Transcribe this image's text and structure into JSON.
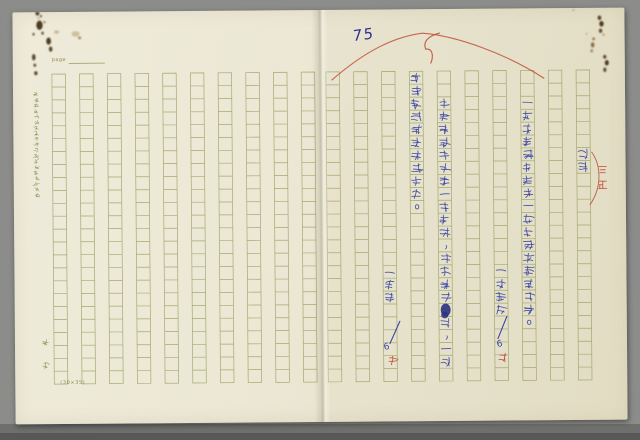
{
  "page_number": "75",
  "stationery": {
    "page_label": "page",
    "grid_label": "(30×35)",
    "brand_vertical": "文觀",
    "margin_note": "本稿紙格式注意事項請用墨筆書寫力求清晰",
    "paper_color": "#ece8d5",
    "grid_color": "#9aa163",
    "columns_per_page": 10,
    "rows_per_column": 24
  },
  "handwriting": {
    "ink_blue": "#3a44a0",
    "ink_red": "#bf4f3a",
    "page_number_color": "#2b3193",
    "columns": [
      {
        "column": 4,
        "start_row": 0,
        "chars": "要比接受批评太易得多。"
      },
      {
        "column": 5,
        "start_row": 2,
        "chars": "迫害是社會公害一性法律，因為到批█评，一直"
      },
      {
        "column": 8,
        "start_row": 2,
        "chars": "—迫害是这種手段一種纸裡之間接解述。"
      },
      {
        "column": 10,
        "start_row": 6,
        "chars": "迫害"
      },
      {
        "column": 3,
        "start_row": 15,
        "chars": "—緯斯"
      },
      {
        "column": 7,
        "start_row": 15,
        "chars": "—好朋思"
      }
    ],
    "proof_marks": [
      {
        "column": 3,
        "slash": "/",
        "number": "6",
        "red_char": "在"
      },
      {
        "column": 7,
        "slash": "/",
        "number": "6",
        "red_char": "在"
      }
    ],
    "margin_correction": "三正"
  },
  "stains": {
    "tones": {
      "d": "#3e2a10",
      "m": "#6e4b1d",
      "l": "#a98e4f"
    },
    "spots": [
      [
        25,
        1,
        2.0,
        2.4,
        "d",
        0.85
      ],
      [
        28.5,
        4,
        1.0,
        1.2,
        "d",
        0.8
      ],
      [
        27,
        13,
        3.2,
        4.6,
        "d",
        0.9
      ],
      [
        32,
        10,
        1.0,
        1.0,
        "d",
        0.7
      ],
      [
        21,
        22,
        1.2,
        1.4,
        "d",
        0.75
      ],
      [
        30,
        21,
        1.3,
        1.5,
        "d",
        0.8
      ],
      [
        36,
        29,
        2.4,
        3.6,
        "d",
        0.9
      ],
      [
        38,
        37,
        1.8,
        2.6,
        "d",
        0.85
      ],
      [
        44,
        20,
        2.6,
        1.8,
        "l",
        0.5
      ],
      [
        63,
        22,
        4.0,
        2.8,
        "l",
        0.45
      ],
      [
        67,
        26,
        1.6,
        1.4,
        "m",
        0.6
      ],
      [
        21,
        45,
        1.8,
        3.2,
        "d",
        0.85
      ],
      [
        22,
        53,
        1.4,
        1.6,
        "d",
        0.8
      ],
      [
        23,
        61,
        1.7,
        2.0,
        "d",
        0.85
      ],
      [
        26,
        6,
        0.7,
        0.8,
        "d",
        0.6
      ],
      [
        587,
        10,
        1.8,
        2.2,
        "d",
        0.85
      ],
      [
        589,
        16,
        2.2,
        2.8,
        "d",
        0.9
      ],
      [
        588,
        23,
        1.7,
        2.1,
        "d",
        0.8
      ],
      [
        591,
        27,
        0.7,
        0.7,
        "d",
        0.9
      ],
      [
        581,
        31,
        1.4,
        1.4,
        "m",
        0.7
      ],
      [
        580,
        37,
        1.8,
        2.6,
        "m",
        0.75
      ],
      [
        579,
        43,
        1.3,
        1.6,
        "m",
        0.6
      ],
      [
        574,
        26,
        0.6,
        0.6,
        "d",
        0.6
      ],
      [
        592,
        49,
        1.6,
        1.9,
        "d",
        0.85
      ],
      [
        594,
        55,
        2.0,
        2.8,
        "d",
        0.9
      ],
      [
        592,
        62,
        1.6,
        2.2,
        "d",
        0.8
      ],
      [
        561,
        2,
        0.9,
        0.9,
        "m",
        0.5
      ]
    ]
  }
}
